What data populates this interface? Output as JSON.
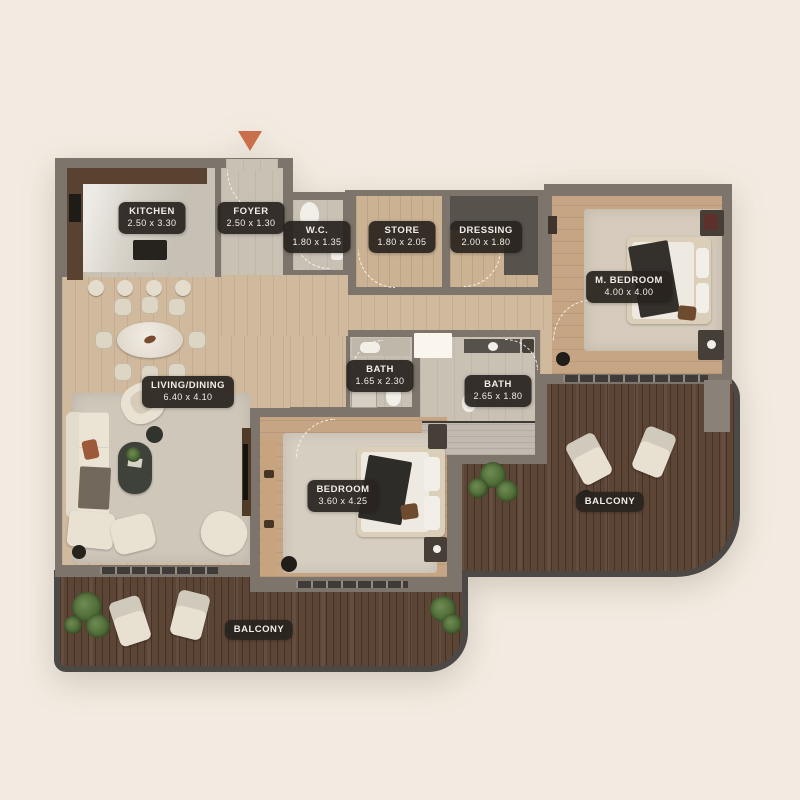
{
  "plan_type": "apartment-floor-plan",
  "colors": {
    "background": "#f2ebe1",
    "wall": "#7d756b",
    "outer_border": "#4c4845",
    "floor_wood": "#d0b99d",
    "floor_tile": "#c9c1b4",
    "balcony_wood": "#5d4536",
    "label_bg": "#29241f",
    "label_text": "#f2eee7",
    "entrance_marker": "#c96f4c",
    "furniture_cream": "#e8e1d2",
    "plant_green": "#47632f"
  },
  "rooms": [
    {
      "id": "kitchen",
      "name": "KITCHEN",
      "dims": "2.50 x 3.30"
    },
    {
      "id": "foyer",
      "name": "FOYER",
      "dims": "2.50 x 1.30"
    },
    {
      "id": "wc",
      "name": "W.C.",
      "dims": "1.80 x 1.35"
    },
    {
      "id": "store",
      "name": "STORE",
      "dims": "1.80 x 2.05"
    },
    {
      "id": "dressing",
      "name": "DRESSING",
      "dims": "2.00 x 1.80"
    },
    {
      "id": "master-bedroom",
      "name": "M. BEDROOM",
      "dims": "4.00 x 4.00"
    },
    {
      "id": "living-dining",
      "name": "LIVING/DINING",
      "dims": "6.40 x 4.10"
    },
    {
      "id": "bath-1",
      "name": "BATH",
      "dims": "1.65 x 2.30"
    },
    {
      "id": "bath-2",
      "name": "BATH",
      "dims": "2.65 x 1.80"
    },
    {
      "id": "bedroom",
      "name": "BEDROOM",
      "dims": "3.60 x 4.25"
    },
    {
      "id": "balcony-right",
      "name": "BALCONY",
      "dims": ""
    },
    {
      "id": "balcony-bottom",
      "name": "BALCONY",
      "dims": ""
    }
  ]
}
